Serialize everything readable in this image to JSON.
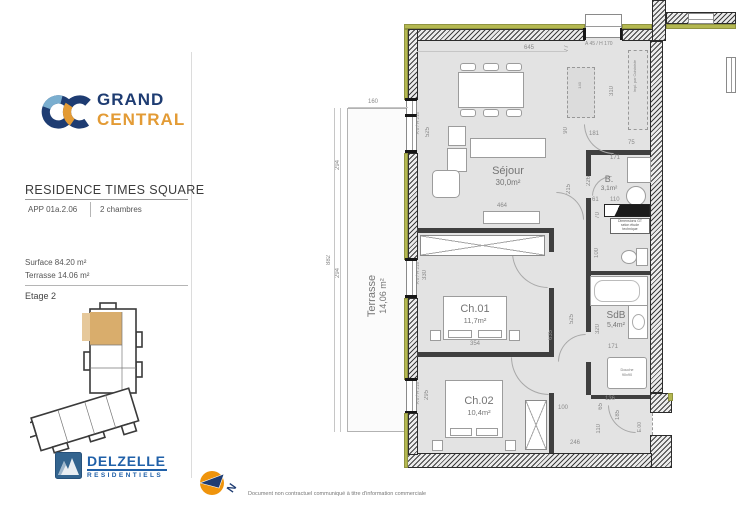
{
  "header": {
    "brand_top": "GRAND",
    "brand_bottom": "CENTRAL",
    "residence": "RESIDENCE TIMES SQUARE",
    "apartment": "APP 01a.2.06",
    "unit_type": "2 chambres"
  },
  "info": {
    "surface": "Surface 84.20 m²",
    "terrace": "Terrasse 14.06 m²",
    "floor": "Etage 2"
  },
  "brand": {
    "name": "DELZELLE",
    "sub": "RESIDENTIELS"
  },
  "footer": {
    "north": "N",
    "disclaimer": "Document non contractuel communiqué à titre d'information commerciale"
  },
  "plan": {
    "rooms": {
      "sejour": {
        "name": "Séjour",
        "area": "30,0m²"
      },
      "terrasse": {
        "name": "Terrasse",
        "area": "14,06 m²"
      },
      "ch01": {
        "name": "Ch.01",
        "area": "11,7m²"
      },
      "ch02": {
        "name": "Ch.02",
        "area": "10,4m²"
      },
      "sdb": {
        "name": "SdB",
        "area": "5,4m²"
      },
      "wc": {
        "name": "B.",
        "area": "3,1m²"
      }
    },
    "windows": {
      "top": "A 45 / H 170",
      "side": "A 0 / H 215"
    },
    "notes": {
      "shaft": "Dimensions GT\nselon étude\ntechnique",
      "kitchen": "Impl. par Cuisiniste",
      "shower": "Douche\n90x90",
      "island": "140",
      "entrance": "E.00"
    },
    "dims": {
      "t160": "160",
      "t645": "645",
      "t77": "77",
      "t310": "310",
      "l294a": "294",
      "l882": "882",
      "l294b": "294",
      "sej525": "525",
      "sej90": "90",
      "sej181": "181",
      "sej75": "75",
      "sej215": "215",
      "sej464": "464",
      "b171": "171",
      "b226": "226",
      "b61": "61",
      "b110": "110",
      "b70": "70",
      "c525": "525",
      "c635": "635",
      "s320": "320",
      "s171": "171",
      "s100": "100",
      "ch1_330": "330",
      "ch1_354": "354",
      "ch2_295": "295",
      "e100": "100",
      "e136": "136",
      "e65": "65",
      "e185": "185",
      "e110": "110",
      "e246": "246"
    },
    "colors": {
      "accent_tan": "#d9ad6c",
      "olive": "#b4b851",
      "navy": "#1e3c72",
      "orange": "#e39b35"
    }
  }
}
